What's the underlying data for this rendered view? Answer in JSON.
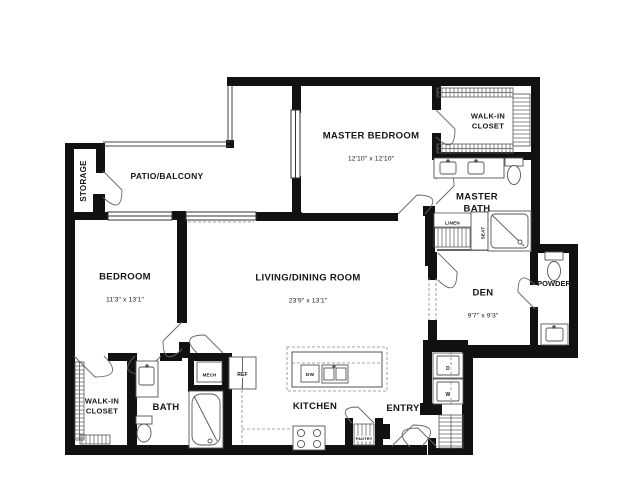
{
  "rooms": {
    "storage": {
      "label": "STORAGE"
    },
    "patio_balcony": {
      "label": "PATIO/BALCONY"
    },
    "master_bedroom": {
      "label": "MASTER BEDROOM",
      "dims": "12'10\" x 12'10\""
    },
    "master_walk_in_closet": {
      "label": "WALK-IN\nCLOSET"
    },
    "master_bath": {
      "label": "MASTER\nBATH"
    },
    "bedroom": {
      "label": "BEDROOM",
      "dims": "11'3\" x 13'1\""
    },
    "living_dining": {
      "label": "LIVING/DINING ROOM",
      "dims": "23'9\" x 13'1\""
    },
    "den": {
      "label": "DEN",
      "dims": "9'7\" x 9'3\""
    },
    "powder": {
      "label": "POWDER"
    },
    "walk_in_closet": {
      "label": "WALK-IN\nCLOSET"
    },
    "bath": {
      "label": "BATH"
    },
    "kitchen": {
      "label": "KITCHEN"
    },
    "entry": {
      "label": "ENTRY"
    }
  },
  "fixtures": {
    "linen": "LINEN",
    "seat": "SEAT",
    "mech": "MECH",
    "ref": "REF",
    "dishwasher": "DW",
    "pantry": "PANTRY",
    "dryer": "D",
    "washer": "W"
  },
  "colors": {
    "wall": "#111111",
    "fixture_line": "#555555",
    "text": "#161616",
    "background": "#ffffff"
  }
}
